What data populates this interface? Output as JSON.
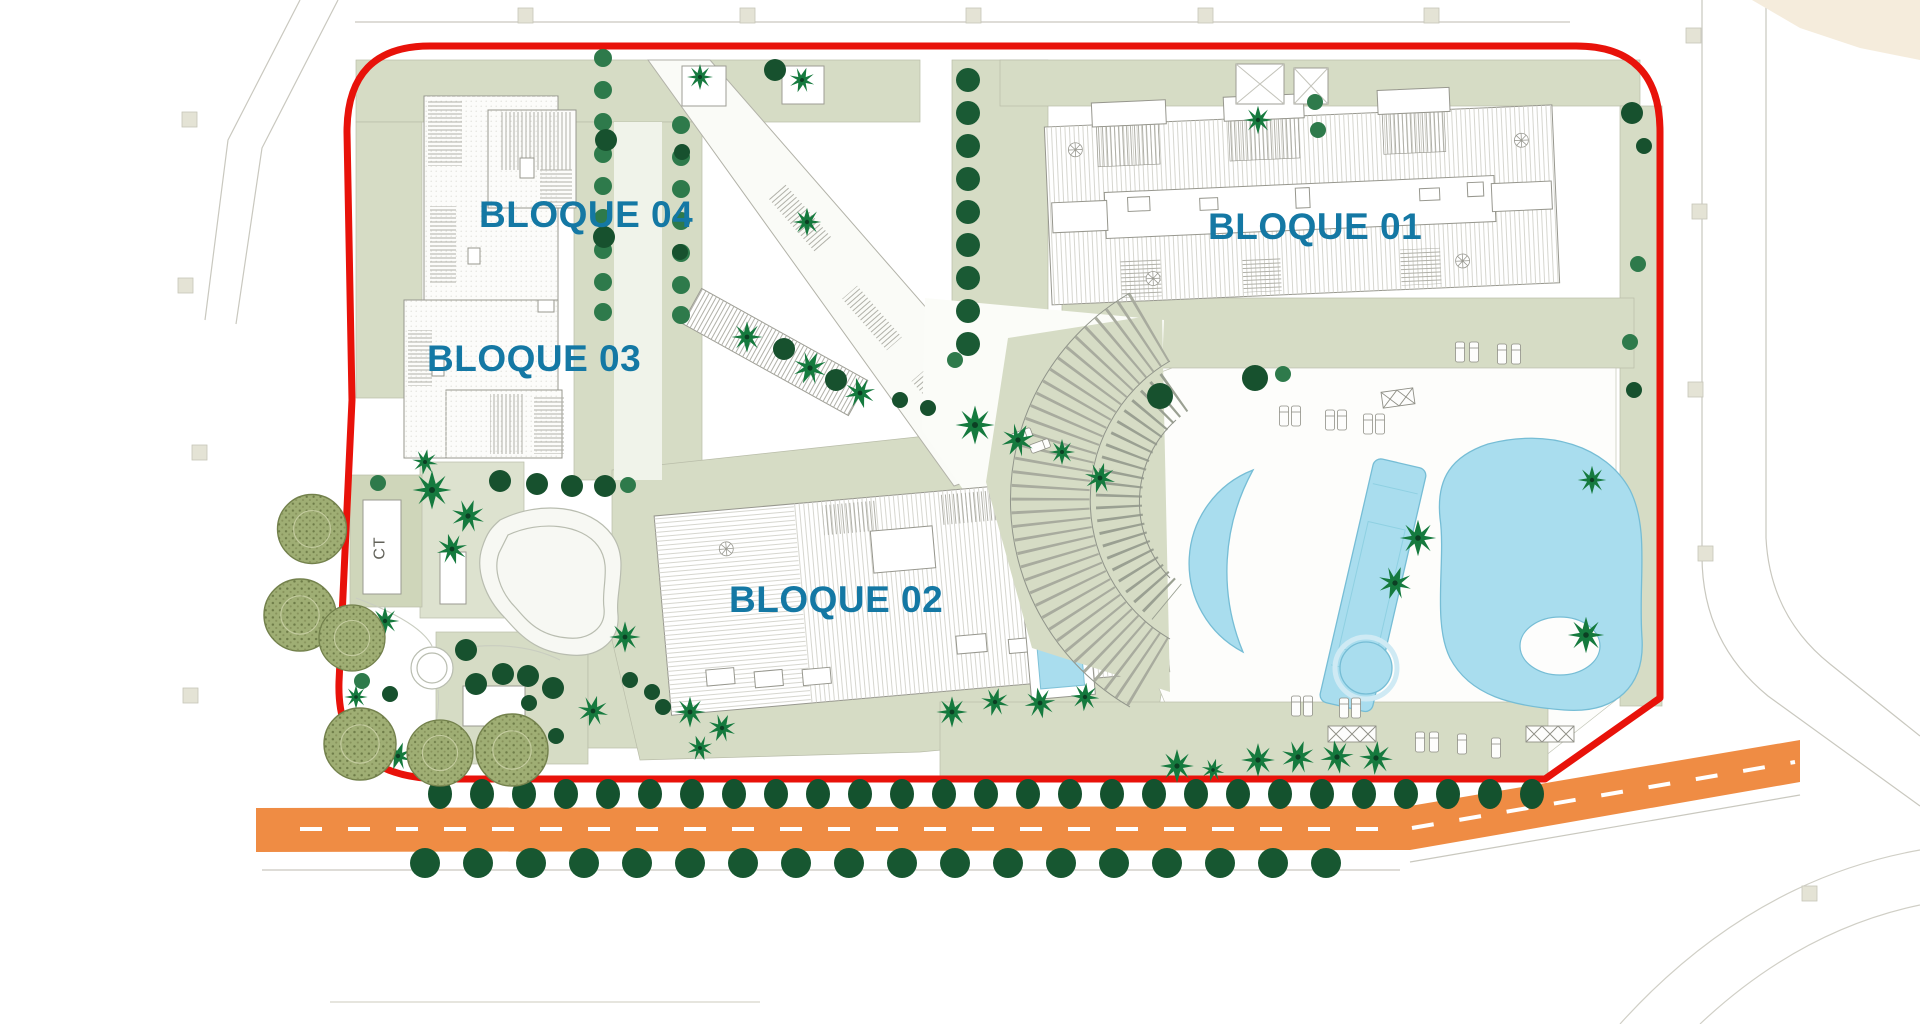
{
  "plan": {
    "type": "Residential site plan",
    "labels": {
      "bloque_01": "BLOQUE 01",
      "bloque_02": "BLOQUE 02",
      "bloque_03": "BLOQUE 03",
      "bloque_04": "BLOQUE 04",
      "ct": "CT"
    },
    "colors": {
      "boundary_red": "#e8120a",
      "road_orange": "#ef8c44",
      "pool_blue": "#a9ddee",
      "lawn_sage": "#d6dcc5",
      "tree_dark_green": "#17512e",
      "palm_green": "#157a3e",
      "olive_green": "#9fae74",
      "label_teal": "#1478a4",
      "building_line_gray": "#97978e"
    }
  }
}
